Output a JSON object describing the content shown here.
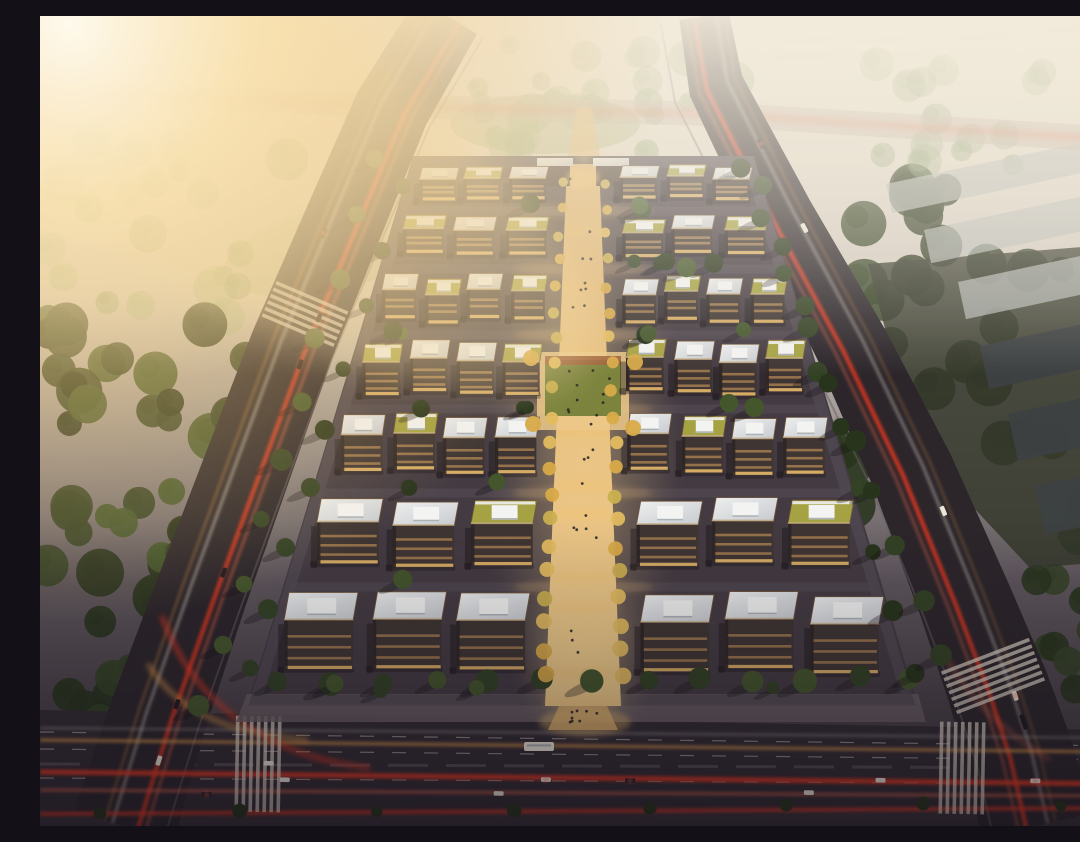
{
  "scene": {
    "description": "Aerial dusk rendering of a rectangular business-park campus: rows of flat-roofed office blocks flanking a warmly lit central pedestrian axis, bounded by tree-lined arterial roads with red and amber traffic light trails, forests to the west, hazy parkland to the north, warehouses to the east, and strong sun glare in the upper-left corner.",
    "canvas": {
      "width": 1080,
      "height": 810
    },
    "palette": {
      "sky_top": "#f3ede1",
      "sky_mid": "#cfc9c2",
      "dusk_mid": "#56505a",
      "dusk_ground": "#2e2833",
      "sun_core": "#fffdf4",
      "sun_warm": "#fbe3b0",
      "glow_amber": "#f2c97e",
      "axis_light": "#f6d492",
      "axis_pav_a": "#d8ae6e",
      "axis_pav_b": "#ecc98b",
      "road_dark": "#221e28",
      "road_bottom": "#292430",
      "road_hazy": "#b7a9a0",
      "lane_white": "#e6ded2",
      "sidewalk": "#645a63",
      "campus_ground": "#3b3440",
      "street_inner": "#4a4350",
      "trail_red": "#e8311f",
      "trail_red2": "#ff6a4e",
      "trail_amber": "#eb9f4a",
      "facade": "#362e30",
      "facade_dark": "#231d21",
      "window_warm": "#dca45f",
      "window_bright": "#f0c06e",
      "roof_white_a": "#eef1f5",
      "roof_white_b": "#c6ccd5",
      "roof_green": "#a2a141",
      "parapet": "#6d5136",
      "parapet_light": "#c3ae8b",
      "unit_white": "#f4f6f9",
      "unit_shade": "#aab1bb",
      "tree_deep": "#1f2d19",
      "tree_dark": "#2a3b21",
      "tree_mid": "#3c5129",
      "field_tree": "#7d996c",
      "hazy_tree_a": "#8ea87e",
      "hazy_tree_b": "#9db58a",
      "lawn_hazy": "#a3b487",
      "plaza_lawn": "#76803a",
      "plaza_terra": "#9c5c38",
      "gold_a": "#d7a946",
      "gold_b": "#c9ae4e",
      "gold_c": "#e3bc5e",
      "warehouse_light": "#b5babd",
      "warehouse_dark": "#343a40",
      "industrial_ground": "#2b3128",
      "shadow": "#0d0a12",
      "people": "#1c1720",
      "car_white": "#ece8df",
      "car_dark": "#17141d",
      "distant_block": "#d8d2c2",
      "vignette": "#120d18"
    },
    "atmosphere": {
      "sun": {
        "cx": 30,
        "cy": 8,
        "r": 600
      },
      "streak": {
        "cx": 180,
        "cy": 120,
        "rx": 430,
        "ry": 150,
        "rot": 32,
        "opacity": 0.28
      },
      "haze_height": 360,
      "vignette_start": 0.62,
      "warm_tint_opacity": 0.05
    },
    "roads": {
      "left": {
        "pts": [
          [
            407,
            0
          ],
          [
            352,
            92
          ],
          [
            300,
            215
          ],
          [
            252,
            330
          ],
          [
            206,
            455
          ],
          [
            162,
            575
          ],
          [
            118,
            700
          ],
          [
            84,
            810
          ]
        ],
        "widths": [
          70,
          76,
          80,
          84,
          88,
          92,
          98,
          104
        ]
      },
      "right": {
        "pts": [
          [
            664,
            0
          ],
          [
            676,
            70
          ],
          [
            742,
            200
          ],
          [
            812,
            330
          ],
          [
            872,
            455
          ],
          [
            925,
            585
          ],
          [
            958,
            672
          ],
          [
            980,
            740
          ],
          [
            996,
            810
          ]
        ],
        "widths": [
          50,
          56,
          64,
          74,
          84,
          94,
          102,
          108,
          112
        ]
      },
      "top": {
        "pts": [
          [
            0,
            76
          ],
          [
            352,
            90
          ],
          [
            672,
            98
          ],
          [
            1080,
            124
          ]
        ],
        "widths": [
          22,
          24,
          24,
          26
        ],
        "opacity": 0.5
      },
      "bottom": {
        "poly": [
          [
            0,
            694
          ],
          [
            1080,
            714
          ],
          [
            1080,
            790
          ],
          [
            0,
            802
          ]
        ],
        "dash_lines": [
          [
            [
              0,
              716
            ],
            [
              1080,
              730
            ]
          ],
          [
            [
              0,
              733
            ],
            [
              1080,
              744
            ]
          ],
          [
            [
              0,
              762
            ],
            [
              1080,
              768
            ]
          ]
        ],
        "median": [
          [
            0,
            748
          ],
          [
            1080,
            752
          ]
        ]
      }
    },
    "trails": {
      "left_offsets": [
        {
          "d": -14,
          "c": "trail_red",
          "w": 4,
          "o": 0.9
        },
        {
          "d": -22,
          "c": "trail_red2",
          "w": 2.2,
          "o": 0.6
        },
        {
          "d": 12,
          "c": "lane_white",
          "w": 2,
          "o": 0.7
        },
        {
          "d": 20,
          "c": "trail_amber",
          "w": 1.8,
          "o": 0.5
        }
      ],
      "right_offsets": [
        {
          "d": 10,
          "c": "trail_red",
          "w": 4,
          "o": 0.9
        },
        {
          "d": 18,
          "c": "trail_red2",
          "w": 2,
          "o": 0.55
        },
        {
          "d": -12,
          "c": "lane_white",
          "w": 2,
          "o": 0.6
        },
        {
          "d": -20,
          "c": "trail_amber",
          "w": 1.6,
          "o": 0.4
        }
      ],
      "bottom_lines": [
        {
          "a": [
            0,
            756
          ],
          "b": [
            1080,
            768
          ],
          "c": "trail_red",
          "w": 5,
          "o": 0.9
        },
        {
          "a": [
            0,
            774
          ],
          "b": [
            1080,
            780
          ],
          "c": "trail_red2",
          "w": 3,
          "o": 0.6
        },
        {
          "a": [
            0,
            798
          ],
          "b": [
            1080,
            792
          ],
          "c": "trail_red",
          "w": 4,
          "o": 0.75
        },
        {
          "a": [
            0,
            724
          ],
          "b": [
            1080,
            736
          ],
          "c": "trail_amber",
          "w": 3,
          "o": 0.75
        },
        {
          "a": [
            0,
            712
          ],
          "b": [
            1080,
            722
          ],
          "c": "lane_white",
          "w": 1.5,
          "o": 0.5
        }
      ],
      "slip_curves": [
        {
          "d": "M122,600 C150,680 220,740 330,752",
          "c": "trail_red",
          "w": 4,
          "o": 0.8
        },
        {
          "d": "M108,648 C140,700 195,718 268,724",
          "c": "trail_amber",
          "w": 3.5,
          "o": 0.8
        },
        {
          "d": "M905,640 Q940,702 1010,744",
          "c": "trail_red2",
          "w": 3,
          "o": 0.5
        }
      ],
      "top_trail": {
        "c": "trail_red",
        "w": 6,
        "o": 0.3
      }
    },
    "crosswalks": [
      {
        "cx": 265,
        "cy": 298,
        "ang": 113,
        "w": 78,
        "n": 6,
        "step": 7
      },
      {
        "cx": 953,
        "cy": 660,
        "ang": 69,
        "w": 94,
        "n": 7,
        "step": 7
      },
      {
        "cx": 218,
        "cy": 748,
        "ang": 1,
        "w": 96,
        "n": 7,
        "step": 7
      },
      {
        "cx": 922,
        "cy": 752,
        "ang": 1,
        "w": 92,
        "n": 7,
        "step": 7
      }
    ],
    "campus": {
      "bounds": {
        "top_y": 140,
        "bottom_y": 690,
        "top_left": 373,
        "top_right": 714,
        "bottom_left": 207,
        "bottom_right": 878
      },
      "poly": [
        [
          373,
          140
        ],
        [
          714,
          140
        ],
        [
          878,
          690
        ],
        [
          207,
          690
        ]
      ],
      "ring": [
        [
          378,
          146
        ],
        [
          709,
          146
        ],
        [
          868,
          684
        ],
        [
          216,
          684
        ]
      ],
      "south_band": [
        [
          207,
          678
        ],
        [
          878,
          678
        ],
        [
          886,
          706
        ],
        [
          196,
          706
        ]
      ],
      "axis": {
        "cx": 543,
        "half_top": 16,
        "half_bottom": 36
      },
      "rows": [
        {
          "y": 150,
          "h": 40,
          "n": 3,
          "roofs": [
            "w",
            "g",
            "w"
          ]
        },
        {
          "y": 202,
          "h": 46,
          "n": 3,
          "roofs": [
            "g",
            "w",
            "g"
          ]
        },
        {
          "y": 260,
          "h": 54,
          "n": 4,
          "roofs": [
            "w",
            "g",
            "w",
            "g"
          ]
        },
        {
          "y": 326,
          "h": 62,
          "n": 4,
          "roofs": [
            "g",
            "w",
            "w",
            "g"
          ]
        },
        {
          "y": 400,
          "h": 68,
          "n": 4,
          "roofs": [
            "w",
            "g",
            "w",
            "w"
          ]
        },
        {
          "y": 484,
          "h": 78,
          "n": 3,
          "roofs": [
            "w",
            "w",
            "g"
          ]
        },
        {
          "y": 578,
          "h": 92,
          "n": 3,
          "roofs": [
            "w",
            "w",
            "w"
          ]
        }
      ],
      "plaza": {
        "x": 497,
        "y": 336,
        "w": 92,
        "h": 78
      },
      "gate": {
        "wings": [
          [
            500,
            148,
            30,
            22
          ],
          [
            556,
            148,
            30,
            22
          ]
        ],
        "glow": [
          543,
          162
        ]
      },
      "north_path": [
        [
          536,
          92
        ],
        [
          552,
          92
        ],
        [
          560,
          140
        ],
        [
          528,
          140
        ]
      ],
      "entrance_path": [
        [
          519,
          690
        ],
        [
          567,
          690
        ],
        [
          578,
          714
        ],
        [
          508,
          714
        ]
      ],
      "glow_spots_y": [
        168,
        214,
        272,
        338,
        416,
        470,
        498,
        562,
        592,
        656,
        686
      ]
    },
    "tree_regions": [
      {
        "x0": 322,
        "y0": 26,
        "x1": 706,
        "y1": 138,
        "count": 30,
        "rmin": 9,
        "rmax": 20,
        "colors": [
          "hazy_tree_a",
          "hazy_tree_b"
        ],
        "opacity": 0.55,
        "seed": 11
      },
      {
        "x0": 0,
        "y0": 120,
        "x1": 330,
        "y1": 310,
        "count": 24,
        "rmin": 10,
        "rmax": 22,
        "colors": [
          "hazy_tree_b",
          "field_tree"
        ],
        "opacity": 0.5,
        "seed": 12
      },
      {
        "x0": 0,
        "y0": 300,
        "x1": 228,
        "y1": 585,
        "count": 44,
        "rmin": 12,
        "rmax": 24,
        "colors": [
          "tree_dark",
          "tree_mid",
          "tree_deep"
        ],
        "opacity": 0.92,
        "seed": 13
      },
      {
        "x0": 0,
        "y0": 585,
        "x1": 150,
        "y1": 805,
        "count": 16,
        "rmin": 10,
        "rmax": 20,
        "colors": [
          "tree_deep",
          "tree_dark"
        ],
        "opacity": 0.9,
        "seed": 14
      },
      {
        "x0": 780,
        "y0": 170,
        "x1": 1080,
        "y1": 560,
        "count": 40,
        "rmin": 12,
        "rmax": 24,
        "colors": [
          "tree_deep",
          "tree_dark"
        ],
        "opacity": 0.88,
        "seed": 15
      },
      {
        "x0": 980,
        "y0": 560,
        "x1": 1080,
        "y1": 730,
        "count": 10,
        "rmin": 9,
        "rmax": 16,
        "colors": [
          "tree_deep",
          "tree_dark"
        ],
        "opacity": 0.85,
        "seed": 16
      },
      {
        "x0": 820,
        "y0": 40,
        "x1": 1080,
        "y1": 170,
        "count": 16,
        "rmin": 10,
        "rmax": 18,
        "colors": [
          "hazy_tree_a",
          "field_tree"
        ],
        "opacity": 0.4,
        "seed": 17
      }
    ],
    "tree_lines": [
      {
        "a": [
          238,
          666
        ],
        "b": [
          872,
          662
        ],
        "n": 13,
        "r": 10,
        "colors": [
          "tree_dark",
          "tree_mid"
        ],
        "shadow": true,
        "seed": 21
      },
      {
        "a": [
          362,
          172
        ],
        "b": [
          212,
          655
        ],
        "n": 9,
        "r": 8.5,
        "colors": [
          "tree_dark",
          "tree_deep"
        ],
        "shadow": true,
        "seed": 22
      },
      {
        "a": [
          726,
          172
        ],
        "b": [
          872,
          655
        ],
        "n": 9,
        "r": 8.5,
        "colors": [
          "tree_dark",
          "tree_deep"
        ],
        "shadow": true,
        "seed": 23
      },
      {
        "a": [
          336,
          140
        ],
        "b": [
          162,
          688
        ],
        "n": 10,
        "r": 9,
        "colors": [
          "tree_mid",
          "tree_dark"
        ],
        "shadow": true,
        "seed": 24
      },
      {
        "a": [
          700,
          150
        ],
        "b": [
          903,
          640
        ],
        "n": 10,
        "r": 9,
        "colors": [
          "tree_dark",
          "tree_deep"
        ],
        "shadow": true,
        "seed": 25
      },
      {
        "a": [
          60,
          796
        ],
        "b": [
          1020,
          788
        ],
        "n": 8,
        "r": 6,
        "colors": [
          "tree_deep"
        ],
        "shadow": false,
        "seed": 26
      }
    ],
    "inner_trees": {
      "per_row": 5,
      "rmin": 6,
      "rmax": 10,
      "seed": 31
    },
    "axis_trees": {
      "y0": 166,
      "y1": 662,
      "step": 26,
      "rmin": 4.5,
      "rmax": 8.5,
      "jitter": 3,
      "colors": [
        "gold_a",
        "gold_b",
        "gold_c"
      ],
      "seed": 41
    },
    "warehouses": {
      "ground": [
        [
          828,
          248
        ],
        [
          1080,
          228
        ],
        [
          1080,
          545
        ],
        [
          990,
          552
        ],
        [
          876,
          430
        ]
      ],
      "light": [
        [
          846,
          168,
          250,
          30
        ],
        [
          884,
          214,
          252,
          34
        ],
        [
          918,
          266,
          238,
          38
        ]
      ],
      "dark": [
        [
          940,
          330,
          230,
          44
        ],
        [
          968,
          398,
          212,
          48
        ],
        [
          995,
          470,
          190,
          50
        ]
      ],
      "rot": -12
    },
    "distant_blocks": {
      "nw": [
        [
          24,
          40
        ],
        [
          90,
          58
        ],
        [
          170,
          44
        ],
        [
          240,
          66
        ],
        [
          60,
          96
        ],
        [
          150,
          104
        ],
        [
          230,
          120
        ],
        [
          20,
          130
        ]
      ],
      "ne_y": [
        14,
        30,
        46,
        62
      ],
      "size": [
        44,
        9
      ],
      "rot": -16,
      "opacity": 0.35,
      "seed": 51
    },
    "vehicles": {
      "bus": {
        "x": 484,
        "y": 726,
        "w": 30,
        "h": 9
      },
      "bottom_lanes": [
        717,
        731,
        746,
        762,
        776
      ],
      "bottom_count": 9,
      "left_count": 6,
      "right_count": 6,
      "lane_offsets": [
        -14,
        14
      ],
      "car_len": 10,
      "car_wid": 4.6,
      "seed": 61
    },
    "people": {
      "axis_count": 26,
      "entrance_count": 8,
      "plaza_count": 6,
      "dot_r": 1.4,
      "seed": 71
    }
  }
}
